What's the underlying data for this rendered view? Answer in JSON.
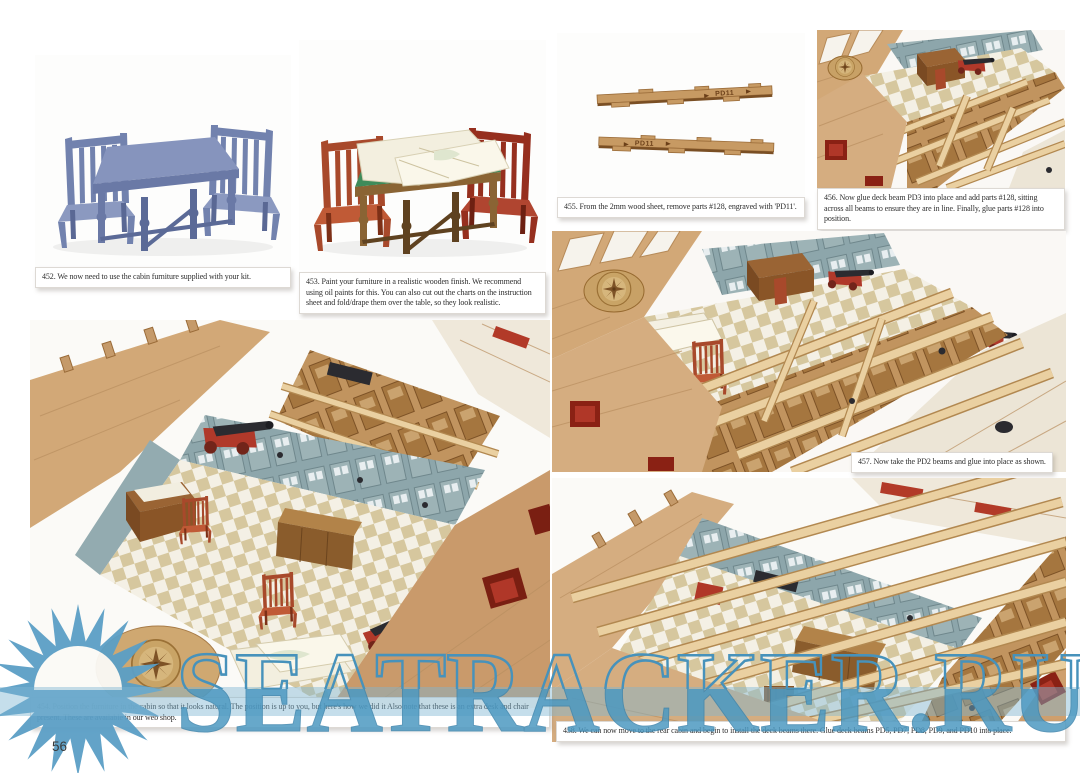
{
  "page": {
    "number": "56"
  },
  "captions": {
    "c452": "452. We now need to use the cabin furniture supplied with your kit.",
    "c453": "453. Paint your furniture in a realistic wooden finish. We recommend using oil paints for this. You can also cut out the charts on the instruction sheet and fold/drape them over the table, so they look realistic.",
    "c454": "454. Position the furniture in the cabin so that it looks natural. The position is up to you, but here's how we did it Also note that these is an extra desk and chair present. These are available in our web shop.",
    "c455": "455. From the 2mm wood sheet, remove parts #128, engraved with 'PD11'.",
    "c456": "456. Now glue deck beam PD3 into place and add parts #128, sitting across all beams to ensure they are in line. Finally, glue parts #128 into position.",
    "c457": "457. Now take the PD2 beams and glue into place as shown.",
    "c458": "458. We can now move to the rear cabin and begin to install the deck beams there. Glue deck beams PD5, PD7, PD8, PD9, and PD10 into place."
  },
  "photos": {
    "p452": "Unpainted blue-grey cabin furniture: table and two chairs",
    "p453": "Cabin furniture painted in wooden finish with charts draped over the table",
    "p454": "Great cabin interior with furniture positioned on the checkered deck",
    "p455": "Two 2mm wood parts #128 engraved PD11",
    "p456": "Deck beam PD3 glued in place with parts #128 sitting across the beams",
    "p457": "PD2 deck beams glued into place over the cabin",
    "p458": "Rear cabin with deck beams PD5, PD7, PD8, PD9 and PD10 installed"
  },
  "parts": {
    "pd11_label": "PD11"
  },
  "watermark": {
    "text": "SEATRACKER.RU",
    "color": "#4b98c1"
  }
}
